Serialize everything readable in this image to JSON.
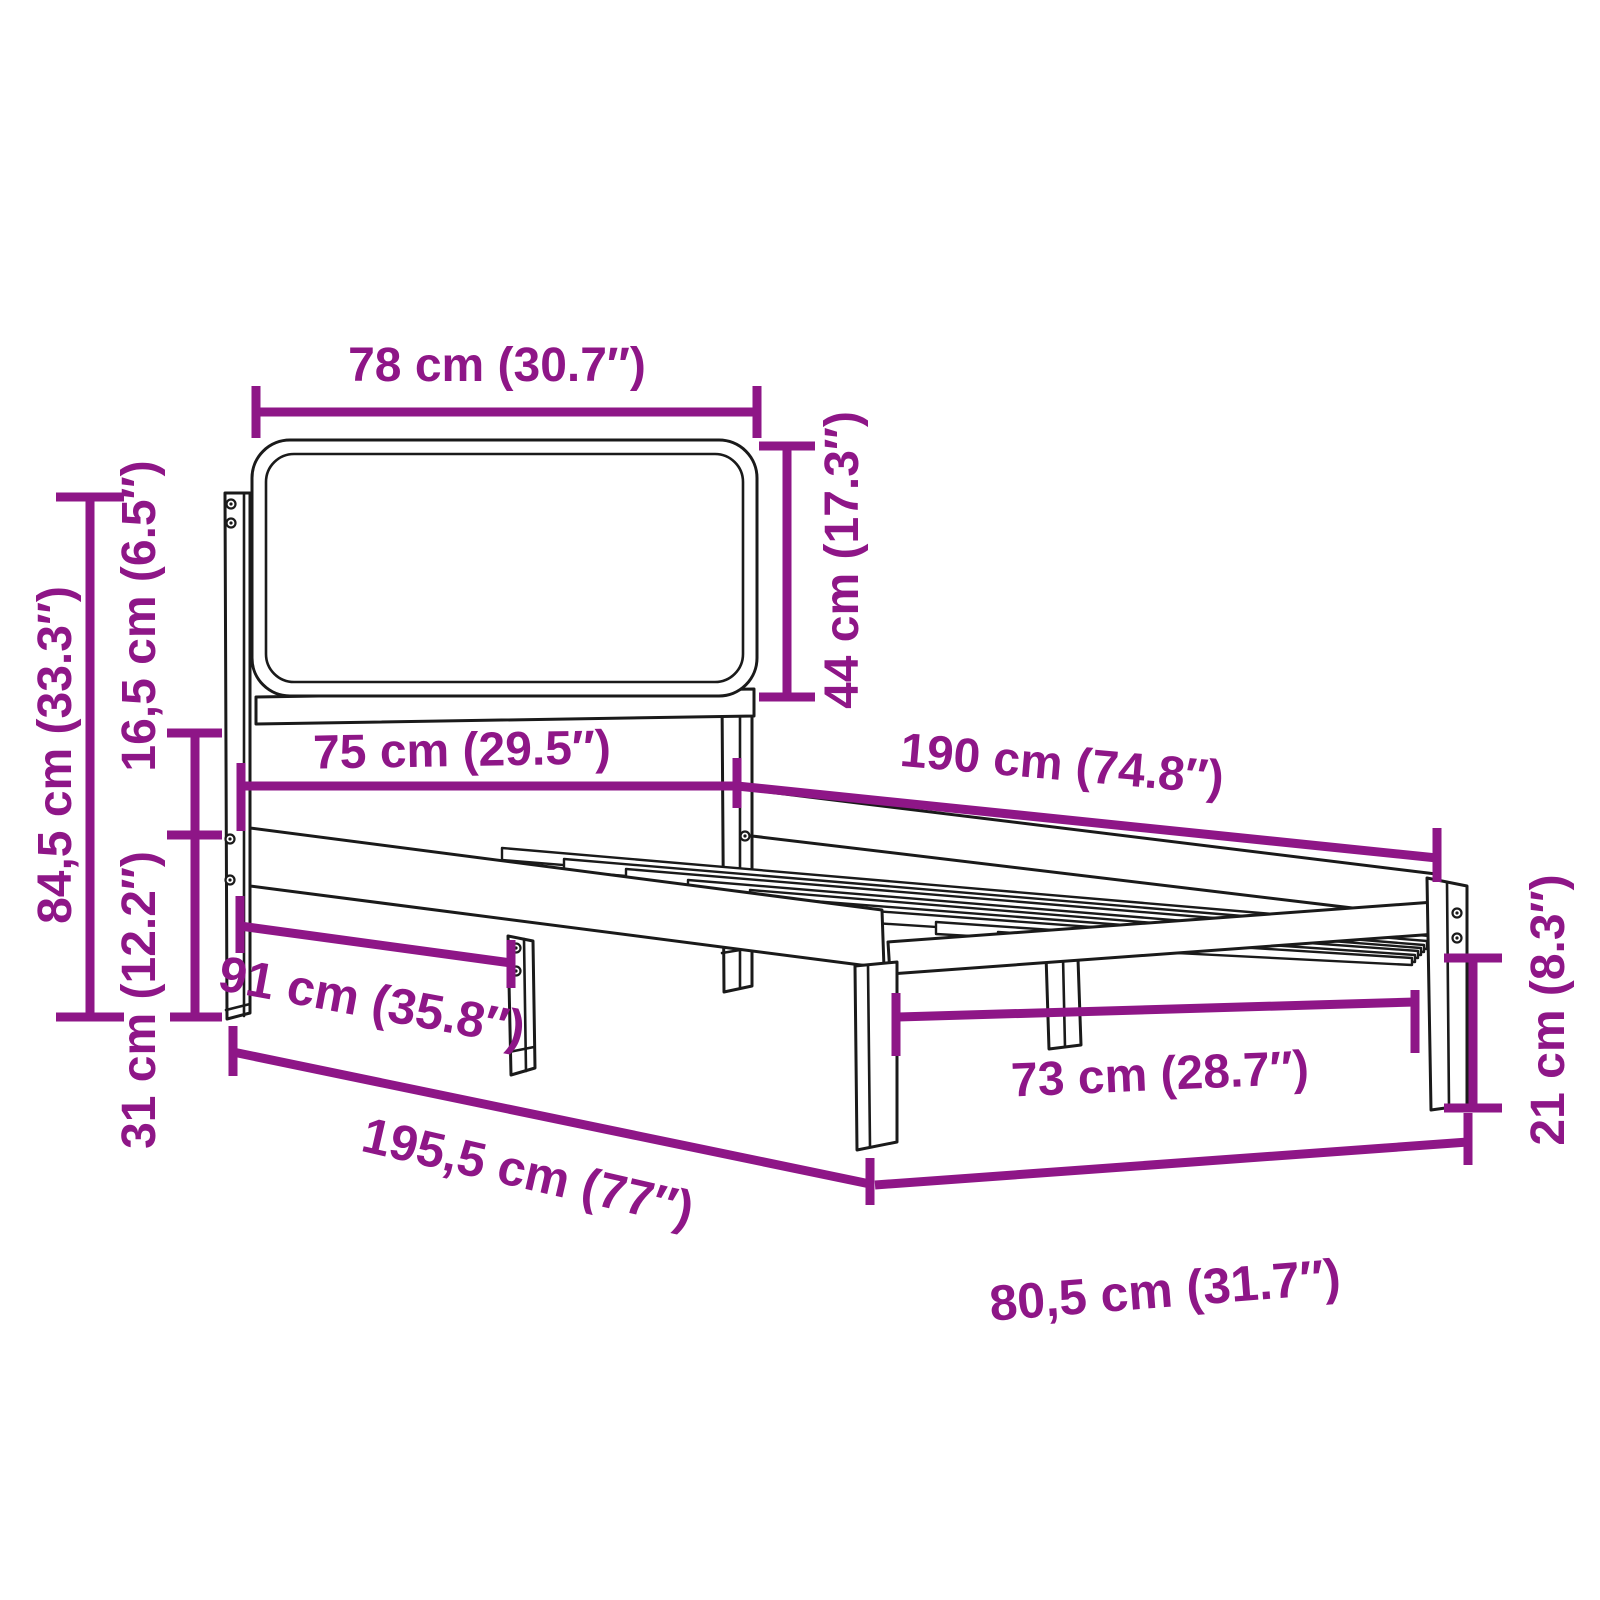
{
  "figure": {
    "title": "Bed frame with upholstered headboard — dimension diagram"
  },
  "colors": {
    "accent": "#8E1687",
    "line": "#1a1a1a",
    "background": "#ffffff"
  },
  "dimensions": {
    "headboard_width": "78 cm (30.7″)",
    "headboard_height": "44 cm (17.3″)",
    "overall_height": "84,5 cm (33.3″)",
    "headboard_clearance": "16,5 cm (6.5″)",
    "frame_height": "31 cm (12.2″)",
    "inner_width": "75 cm (29.5″)",
    "inner_length": "190 cm (74.8″)",
    "rail_leg_span": "91 cm (35.8″)",
    "overall_length": "195,5 cm (77″)",
    "foot_leg_span": "73 cm (28.7″)",
    "leg_height": "21 cm (8.3″)",
    "overall_width": "80,5 cm (31.7″)"
  }
}
